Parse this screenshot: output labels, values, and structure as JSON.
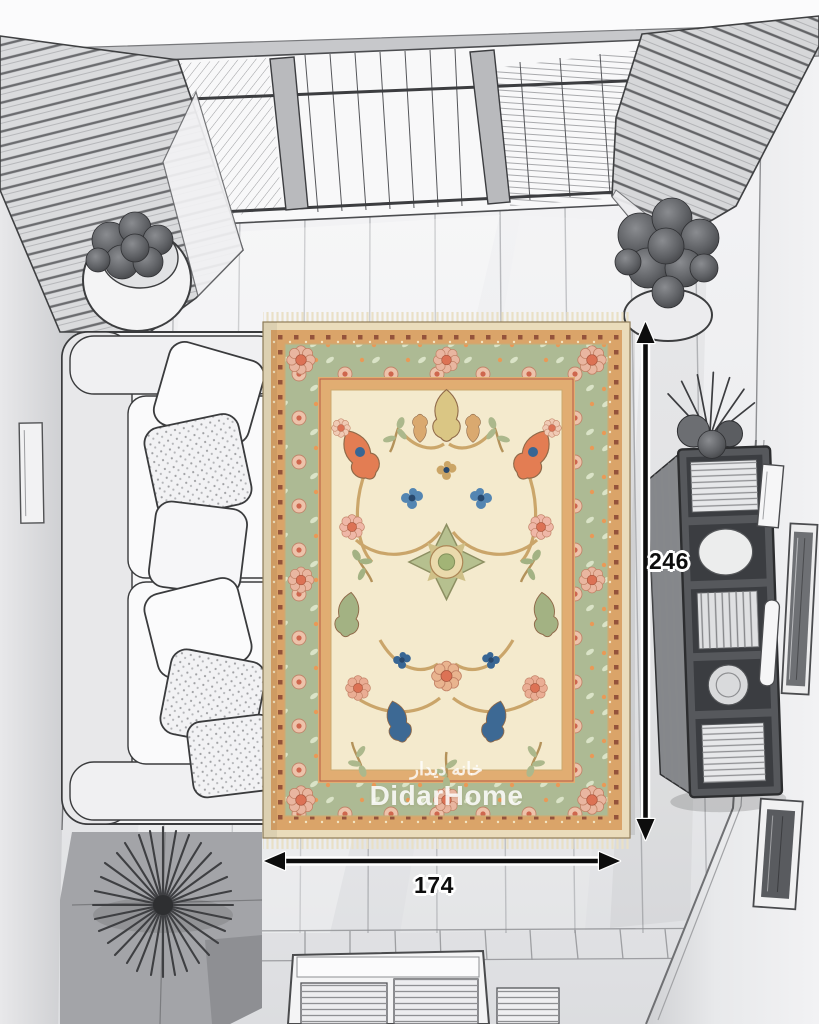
{
  "brand": {
    "watermark_fa": "خانه دیدار",
    "watermark_en": "DidarHome"
  },
  "annotations": {
    "height_label": "246",
    "width_label": "174",
    "arrow_color": "#0d0d0d"
  },
  "rug": {
    "field_color": "#f4e9cb",
    "border_color": "#a9b78f",
    "guard_color": "#d9a061",
    "accent_orange": "#e2764a",
    "accent_pink": "#efb4a3",
    "accent_blue": "#2e5e8f",
    "pattern": "floral oriental"
  },
  "scene": {
    "description": "Top-down pencil-sketch living room with colored oriental rug and size arrows",
    "elements": [
      "skylight window",
      "curtains",
      "potted plants",
      "sofa with pillows",
      "bookshelf with books",
      "wall frames",
      "slatted bench",
      "floor planks",
      "dimension arrows"
    ]
  }
}
